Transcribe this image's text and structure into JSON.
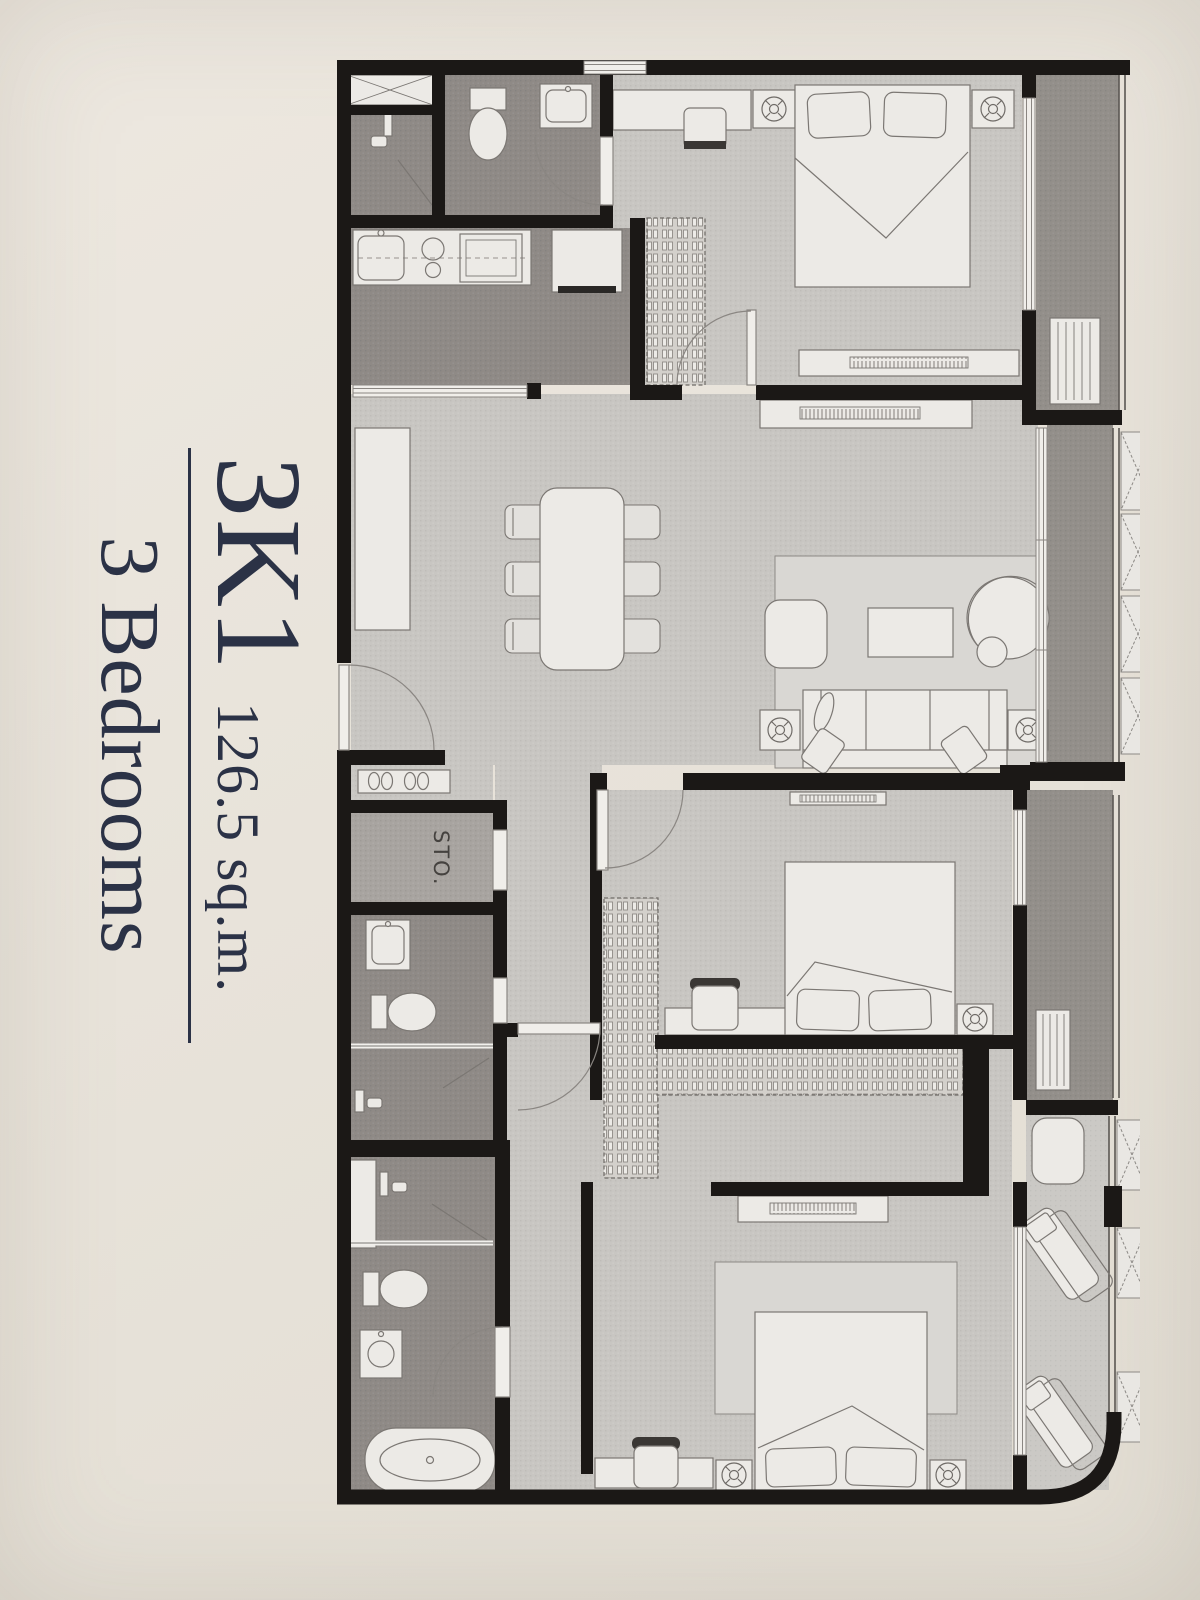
{
  "unit": {
    "code": "3K1",
    "area": "126.5 sq.m.",
    "bedrooms": "3 Bedrooms"
  },
  "plan": {
    "storage_label": "STO."
  },
  "style": {
    "paper_color": "#e8e3da",
    "ink_color": "#2b3246",
    "wall_color": "#1b1816",
    "floor_light": "#c8c6c2",
    "floor_dark": "#8f8a86",
    "floor_storage": "#a8a4a0",
    "floor_balcony": "#938f8a",
    "furniture_color": "#eceae6"
  }
}
